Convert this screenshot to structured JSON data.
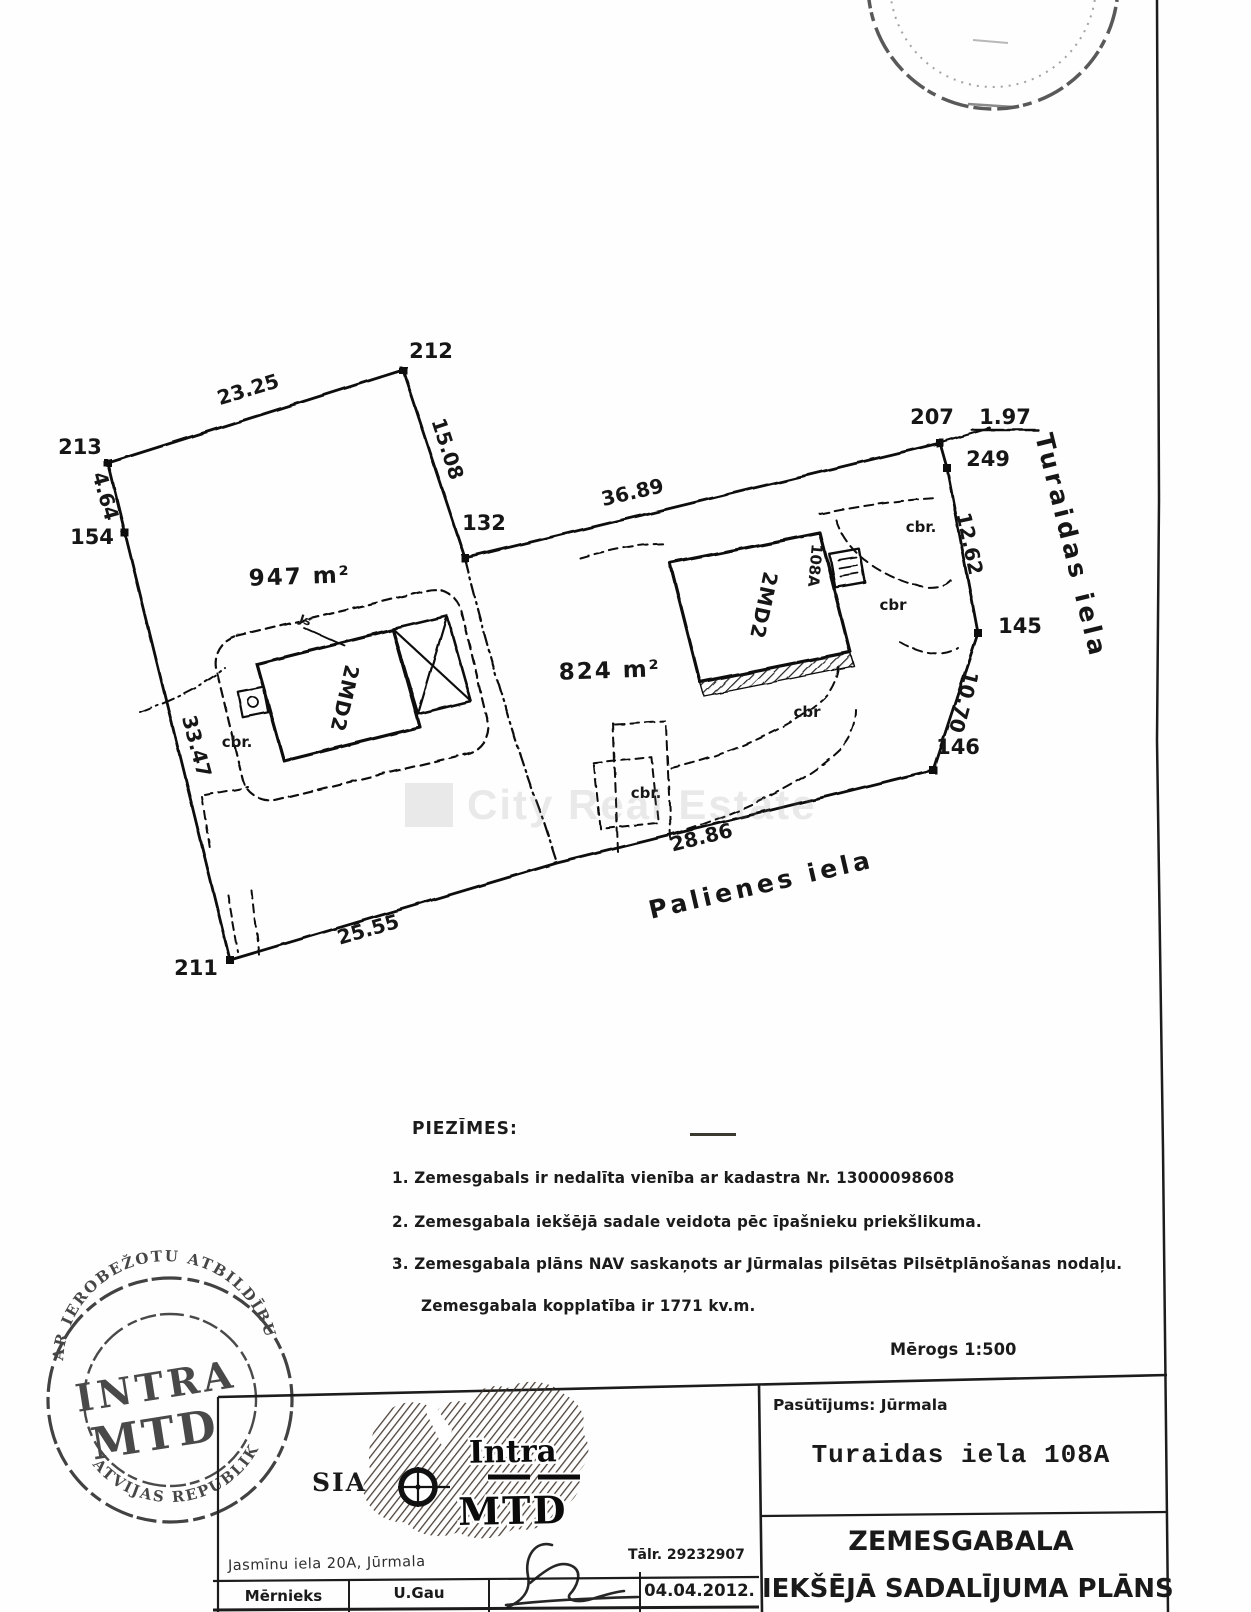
{
  "page": {
    "watermark_text": "City Real Estate",
    "scale_label": "Mērogs   1:500"
  },
  "plan": {
    "area_left": "947 m²",
    "area_right": "824 m²",
    "street_east": "Turaidas  iela",
    "street_south": "Palienes  iela",
    "building_left": "2MD2",
    "building_right": "2MD2",
    "house_no": "108A",
    "cbr1": "cbr.",
    "cbr2": "cbr",
    "cbr3": "cbr",
    "cbr4": "cbr.",
    "cbr5": "cbr.",
    "js": "Js",
    "points": {
      "p212": "212",
      "p213": "213",
      "p154": "154",
      "p132": "132",
      "p207": "207",
      "p249": "249",
      "p145": "145",
      "p146": "146",
      "p211": "211"
    },
    "dims": {
      "d23_25": "23.25",
      "d4_64": "4.64",
      "d15_08": "15.08",
      "d36_89": "36.89",
      "d1_97": "1.97",
      "d12_62": "12.62",
      "d10_70": "10.70",
      "d28_86": "28.86",
      "d25_55": "25.55",
      "d33_47": "33.47"
    }
  },
  "notes": {
    "heading": "PIEZĪMES:",
    "item1": "1. Zemesgabals ir nedalīta vienība ar kadastra Nr. 13000098608",
    "item2": "2. Zemesgabala iekšējā sadale veidota pēc  īpašnieku priekšlikuma.",
    "item3": "3. Zemesgabala plāns NAV saskaņots ar Jūrmalas pilsētas Pilsētplānošanas nodaļu.",
    "total": "Zemesgabala kopplatība ir 1771 kv.m."
  },
  "titleblock": {
    "sia": "SIA",
    "logo_top": "Intra",
    "logo_bottom": "MTD",
    "address": "Jasmīnu  iela  20A,  Jūrmala",
    "phone": "Tālr. 29232907",
    "surveyor_label": "Mērnieks",
    "surveyor_name": "U.Gau",
    "date": "04.04.2012.",
    "order": "Pasūtījums: Jūrmala",
    "object_address": "Turaidas  iela  108A",
    "title1": "ZEMESGABALA",
    "title2": "IEKŠĒJĀ SADALĪJUMA PLĀNS"
  },
  "stamp": {
    "arc_top": "AR  IEROBEŽOTU  ATBILDĪBU",
    "arc_bottom": "LATVIJAS  REPUBLIKA",
    "line1": "INTRA",
    "line2": "MTD"
  }
}
